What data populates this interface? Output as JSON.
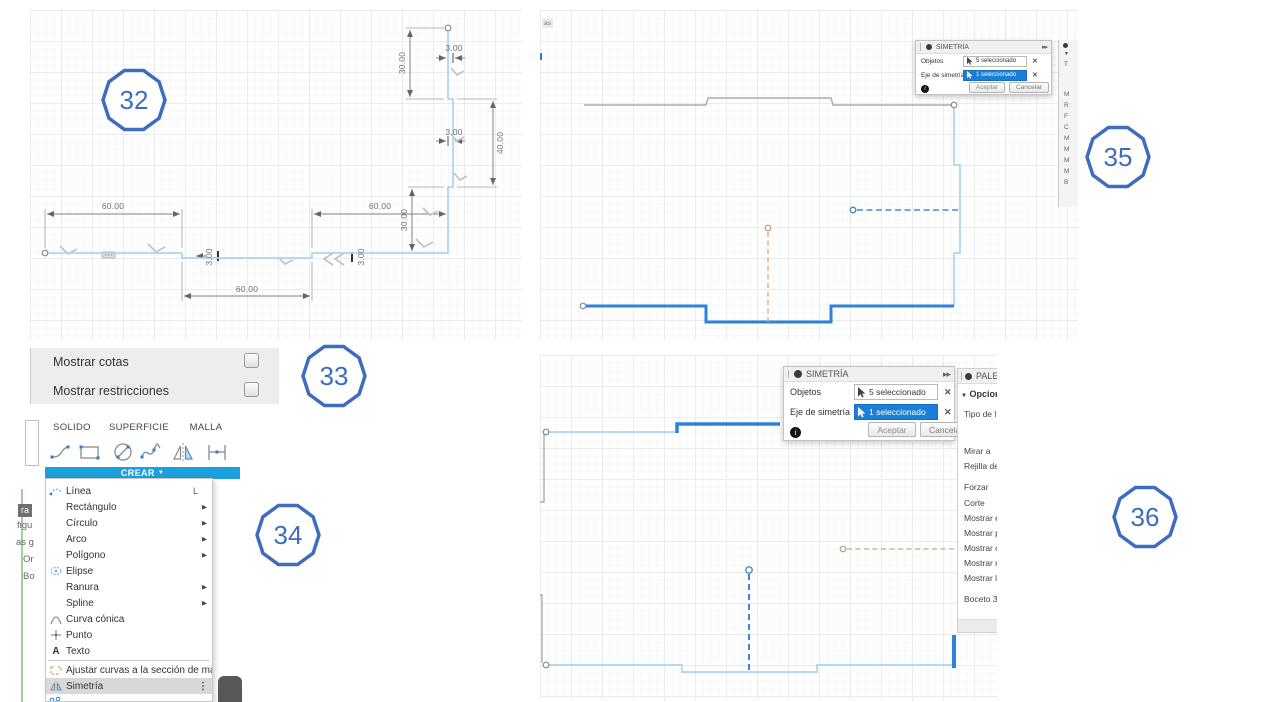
{
  "icons": {
    "caret_down": "▼",
    "submenu": "▶",
    "ellipsis": "⋮",
    "close": "✕",
    "detach": "▸▸",
    "info": "i",
    "text_icon": "A",
    "section_caret": "▼"
  },
  "badges": {
    "b32": "32",
    "b33": "33",
    "b34": "34",
    "b35": "35",
    "b36": "36"
  },
  "shot32": {
    "dims": {
      "left60": "60.00",
      "right60": "60.00",
      "bottom60": "60.00",
      "top30": "30.00",
      "right40": "40.00",
      "mid30": "30.00",
      "top3": "3.00",
      "mid3": "3.00",
      "left3": "3.00",
      "right3": "3.00"
    }
  },
  "shot33": {
    "items": [
      {
        "label": "Mostrar cotas"
      },
      {
        "label": "Mostrar restricciones"
      }
    ]
  },
  "shot34": {
    "tabs": [
      {
        "label": "SOLIDO"
      },
      {
        "label": "SUPERFICIE"
      },
      {
        "label": "MALLA"
      }
    ],
    "create_button": "CREAR",
    "menu": [
      {
        "label": "Línea",
        "shortcut": "L"
      },
      {
        "label": "Rectángulo"
      },
      {
        "label": "Círculo"
      },
      {
        "label": "Arco"
      },
      {
        "label": "Polígono"
      },
      {
        "label": "Elipse"
      },
      {
        "label": "Ranura"
      },
      {
        "label": "Spline"
      },
      {
        "label": "Curva cónica"
      },
      {
        "label": "Punto"
      },
      {
        "label": "Texto"
      },
      {
        "label": "Ajustar curvas a la sección de malla"
      },
      {
        "label": "Simetría"
      }
    ],
    "fragments": [
      {
        "text": "ra"
      },
      {
        "text": "figu"
      },
      {
        "text": "as g"
      },
      {
        "text": "Or"
      },
      {
        "text": "Bo"
      }
    ]
  },
  "shot35": {
    "corner_fragment": "as",
    "dialog": {
      "title": "SIMETRÍA",
      "rows": [
        {
          "label": "Objetos",
          "value": "5 seleccionado"
        },
        {
          "label": "Eje de simetría",
          "value": "1 seleccionado"
        }
      ],
      "accept": "Aceptar",
      "cancel": "Cancelar"
    },
    "palette_strip": [
      {
        "ch": "T"
      },
      {
        "ch": "M"
      },
      {
        "ch": "R"
      },
      {
        "ch": "F"
      },
      {
        "ch": "C"
      },
      {
        "ch": "M"
      },
      {
        "ch": "M"
      },
      {
        "ch": "M"
      },
      {
        "ch": "M"
      },
      {
        "ch": "B"
      }
    ]
  },
  "shot36": {
    "dialog": {
      "title": "SIMETRÍA",
      "rows": [
        {
          "label": "Objetos",
          "value": "5 seleccionado"
        },
        {
          "label": "Eje de simetría",
          "value": "1 seleccionado"
        }
      ],
      "accept": "Aceptar",
      "cancel": "Cancelar"
    },
    "palette": {
      "header": "PALETA",
      "section": "Opcione",
      "items": [
        {
          "label": "Tipo de lín"
        },
        {
          "label": "Mirar a"
        },
        {
          "label": "Rejilla del l"
        },
        {
          "label": "Forzar"
        },
        {
          "label": "Corte"
        },
        {
          "label": "Mostrar el"
        },
        {
          "label": "Mostrar pu"
        },
        {
          "label": "Mostrar co"
        },
        {
          "label": "Mostrar re"
        },
        {
          "label": "Mostrar la"
        },
        {
          "label": "Boceto 3D"
        }
      ]
    }
  }
}
